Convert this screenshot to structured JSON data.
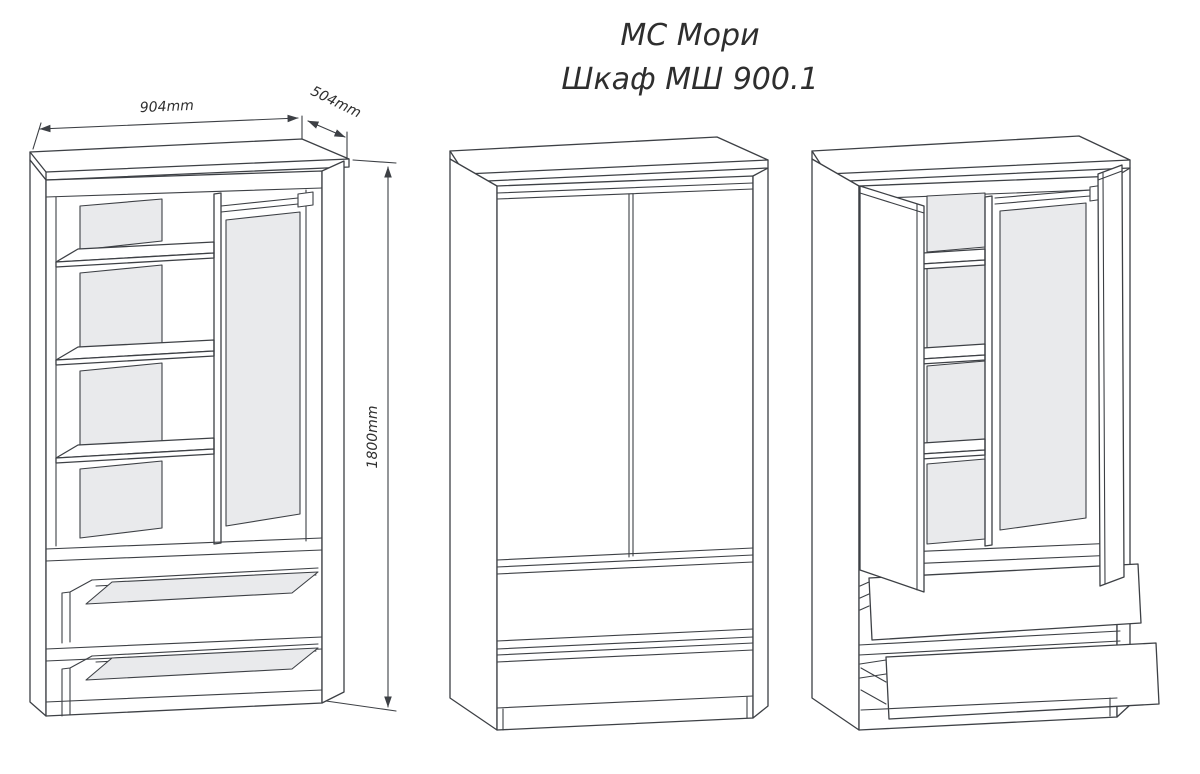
{
  "title": {
    "line1": "МС Мори",
    "line2": "Шкаф МШ 900.1"
  },
  "dimensions": {
    "width": "904mm",
    "depth": "504mm",
    "height": "1800mm"
  },
  "colors": {
    "line": "#3d4045",
    "panel_fill": "#e9eaec",
    "text": "#2e2e2e",
    "background": "#ffffff"
  }
}
